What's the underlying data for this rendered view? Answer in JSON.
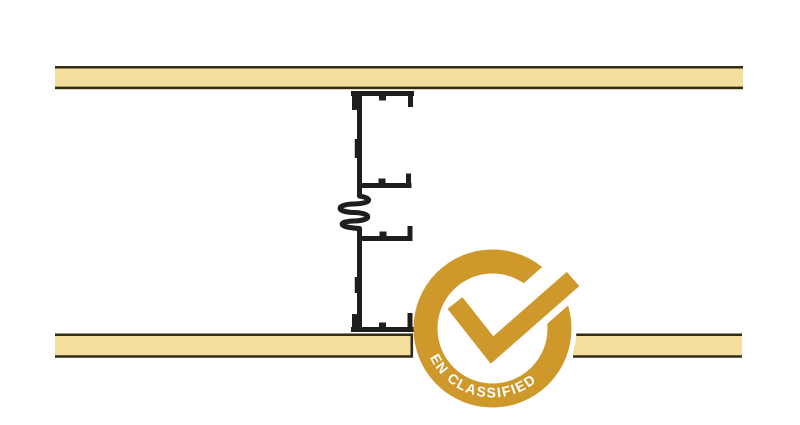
{
  "diagram": {
    "parts": {
      "top_board": "plasterboard-top",
      "bottom_board": "plasterboard-bottom",
      "stud": "acoustic-stud-profile",
      "spring": "resilient-connection"
    },
    "colors": {
      "board_fill": "#F3DE9D",
      "board_border": "#332C19",
      "stud": "#201E1C"
    }
  },
  "badge": {
    "text": "EN CLASSIFIED",
    "color": "#CE982B",
    "halo_color": "#FFFFFF",
    "text_color": "#FFFFFF"
  }
}
